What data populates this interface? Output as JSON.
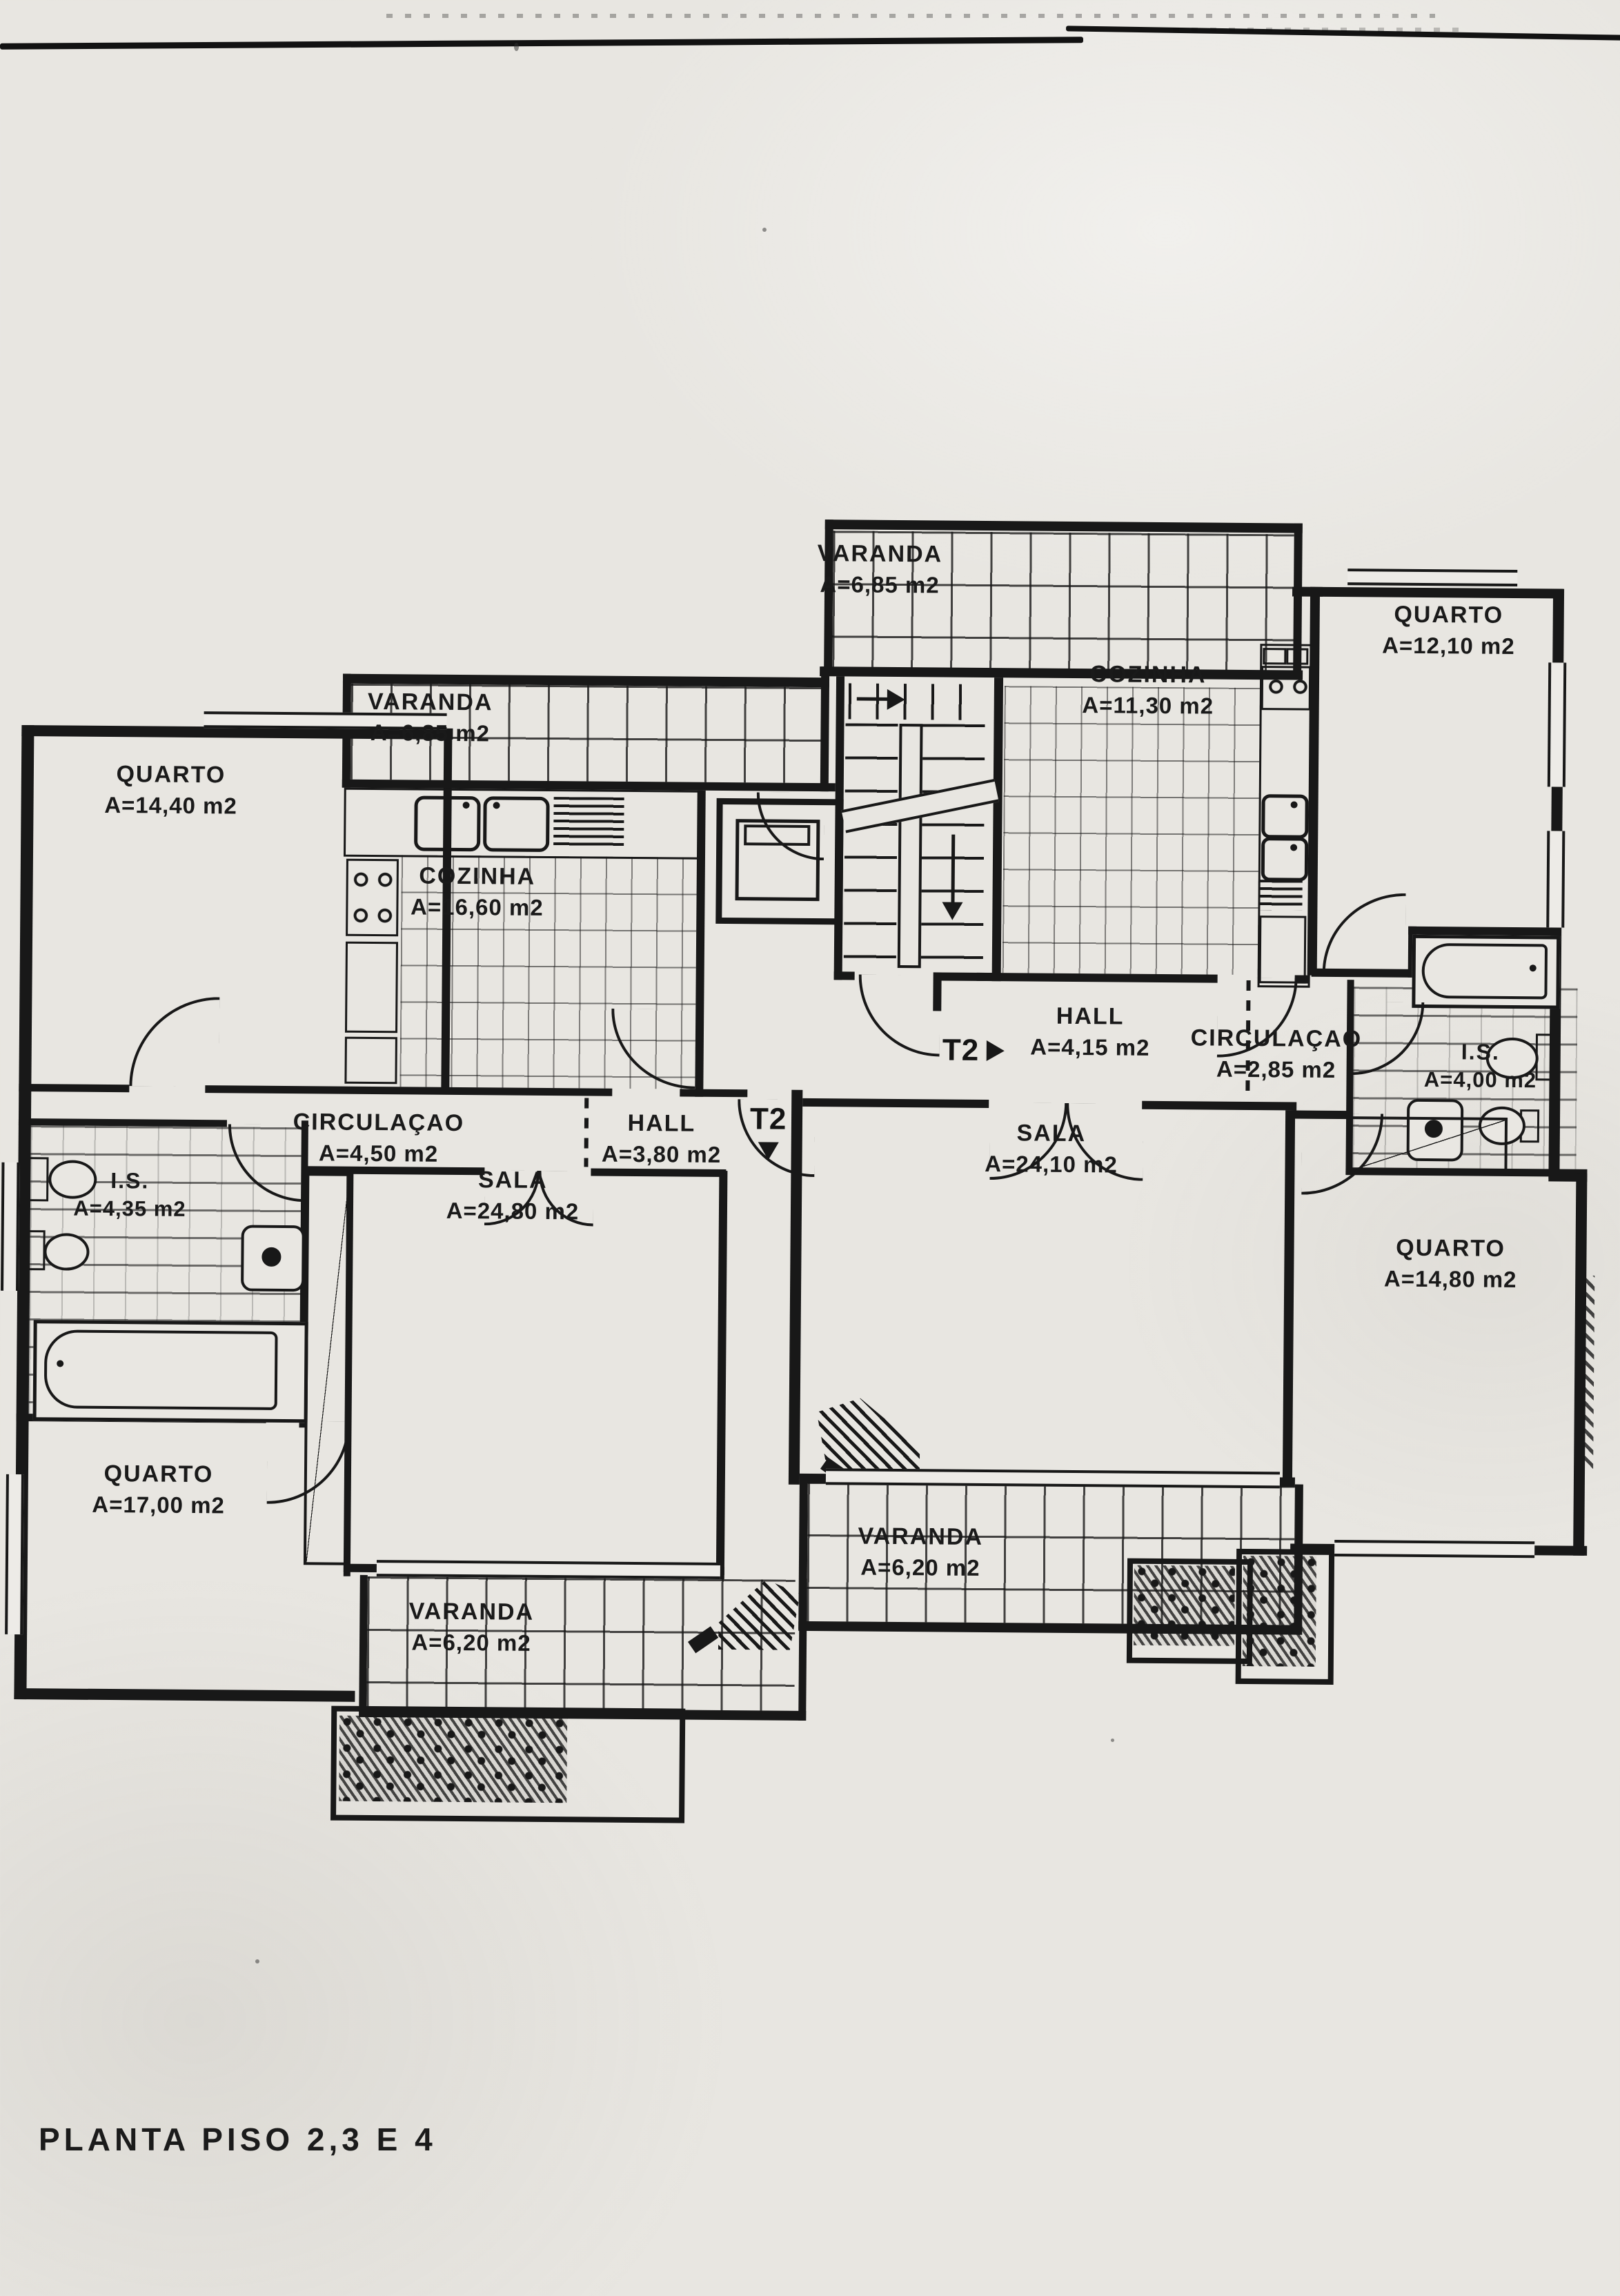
{
  "document": {
    "title": "PLANTA PISO 2,3 E 4"
  },
  "markers": {
    "t2_right": "T2",
    "t2_left": "T2"
  },
  "rooms": [
    {
      "id": "varanda_top",
      "label": "VARANDA",
      "area": "A=6,85 m2"
    },
    {
      "id": "quarto_top_right",
      "label": "QUARTO",
      "area": "A=12,10 m2"
    },
    {
      "id": "cozinha_right",
      "label": "COZINHA",
      "area": "A=11,30 m2"
    },
    {
      "id": "varanda_top_left",
      "label": "VARANDA",
      "area": "A=6,85 m2"
    },
    {
      "id": "quarto_top_left",
      "label": "QUARTO",
      "area": "A=14,40 m2"
    },
    {
      "id": "cozinha_left",
      "label": "COZINHA",
      "area": "A=16,60 m2"
    },
    {
      "id": "hall_right",
      "label": "HALL",
      "area": "A=4,15 m2"
    },
    {
      "id": "circulacao_right",
      "label": "CIRCULAÇAO",
      "area": "A=2,85 m2"
    },
    {
      "id": "is_right",
      "label": "I.S.",
      "area": "A=4,00 m2"
    },
    {
      "id": "circulacao_left",
      "label": "CIRCULAÇAO",
      "area": "A=4,50 m2"
    },
    {
      "id": "hall_left",
      "label": "HALL",
      "area": "A=3,80 m2"
    },
    {
      "id": "sala_right",
      "label": "SALA",
      "area": "A=24,10 m2"
    },
    {
      "id": "is_left",
      "label": "I.S.",
      "area": "A=4,35 m2"
    },
    {
      "id": "sala_left",
      "label": "SALA",
      "area": "A=24,80 m2"
    },
    {
      "id": "quarto_bottom_right",
      "label": "QUARTO",
      "area": "A=14,80 m2"
    },
    {
      "id": "quarto_bottom_left",
      "label": "QUARTO",
      "area": "A=17,00 m2"
    },
    {
      "id": "varanda_mid",
      "label": "VARANDA",
      "area": "A=6,20 m2"
    },
    {
      "id": "varanda_bottom_left",
      "label": "VARANDA",
      "area": "A=6,20 m2"
    }
  ],
  "colors": {
    "ink": "#181818",
    "paper": "#e8e6e1"
  }
}
